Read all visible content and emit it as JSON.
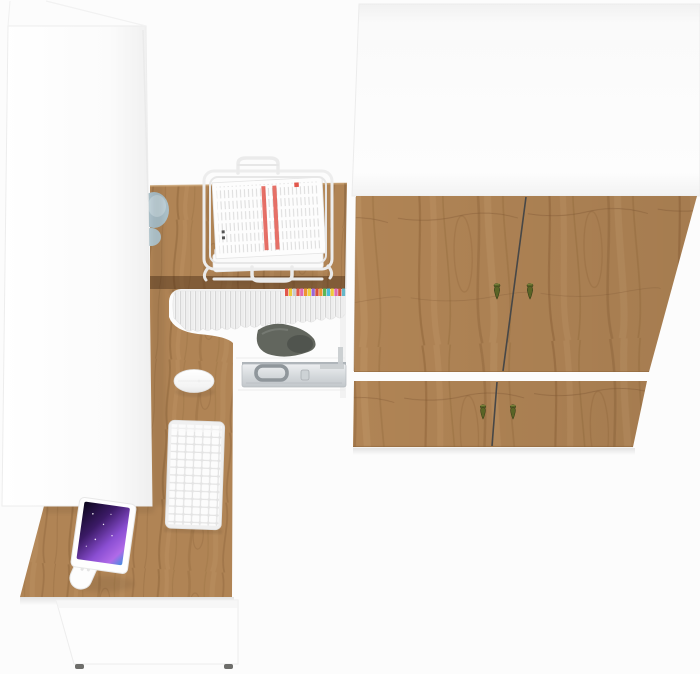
{
  "scene": {
    "title": "Top-down 3D render of a home office furniture set: L-shaped oak desk with keyboard, mouse, monitor and wire paper tray, tall white cabinet, white drawer unit, and an oak-door wardrobe",
    "objects": {
      "wardrobe": {
        "label": "Wardrobe with oak doors"
      },
      "wardrobe_top": {
        "label": "Wardrobe white top panel"
      },
      "upper_doors": {
        "label": "Wardrobe upper door pair"
      },
      "lower_doors": {
        "label": "Wardrobe lower door pair"
      },
      "upper_seam": {
        "label": "Gap between upper doors"
      },
      "lower_seam": {
        "label": "Gap between lower doors"
      },
      "handles": {
        "label": "Olive teardrop door handle",
        "count": 4
      },
      "cabinet": {
        "label": "Tall white cabinet"
      },
      "desk": {
        "label": "L-shaped oak corner desk"
      },
      "desk_edge": {
        "label": "Dark oak desk front edge band"
      },
      "files": {
        "label": "Row of files and magazines on desk shelf"
      },
      "file_tabs": {
        "label": "Colored index tabs on files"
      },
      "paper_tray": {
        "label": "White wire paper tray"
      },
      "documents": {
        "label": "Stack of documents with red stripes"
      },
      "keyboard": {
        "label": "White wireless keyboard"
      },
      "mouse": {
        "label": "White wireless mouse"
      },
      "monitor": {
        "label": "Monitor showing purple space wallpaper"
      },
      "monitor_arm": {
        "label": "White articulated monitor arm"
      },
      "briefcase": {
        "label": "Silver briefcase under the desk"
      },
      "bag": {
        "label": "Dark gray bag under the desk"
      },
      "bin": {
        "label": "Blue-gray bin beside the cabinet"
      },
      "drawer_unit": {
        "label": "White drawer unit below the desk"
      }
    }
  },
  "colors": {
    "background": "#fcfcfc",
    "white_furniture": "#fdfdfd",
    "wood_base": "#b08455",
    "wood_dark": "#8a6137",
    "wood_light": "#c79c6d",
    "desk_edge_dark": "#7d5533",
    "seam_dark": "#474747",
    "handle_olive": "#5a6426",
    "handle_olive_dark": "#39411a",
    "screen_dark": "#0c071c",
    "screen_purple": "#8a4ed2",
    "screen_violet": "#b06ae8",
    "screen_blue": "#3f8fe0",
    "paper_red": "#e2574c",
    "briefcase_silver": "#ced3d6",
    "briefcase_handle": "#8f969b",
    "bag_gray": "#62665e",
    "bin_blue": "#aabfc8"
  },
  "file_tabs": [
    "#e2574c",
    "#eecb3a",
    "#c9c9c9",
    "#e2574c",
    "#e06ab0",
    "#ef9431",
    "#eed23c",
    "#9b66d4",
    "#d94f3a",
    "#ef9431",
    "#5cb653",
    "#49bcd8",
    "#eecb3a",
    "#e06ab0",
    "#d94f3a",
    "#67b8c9"
  ]
}
